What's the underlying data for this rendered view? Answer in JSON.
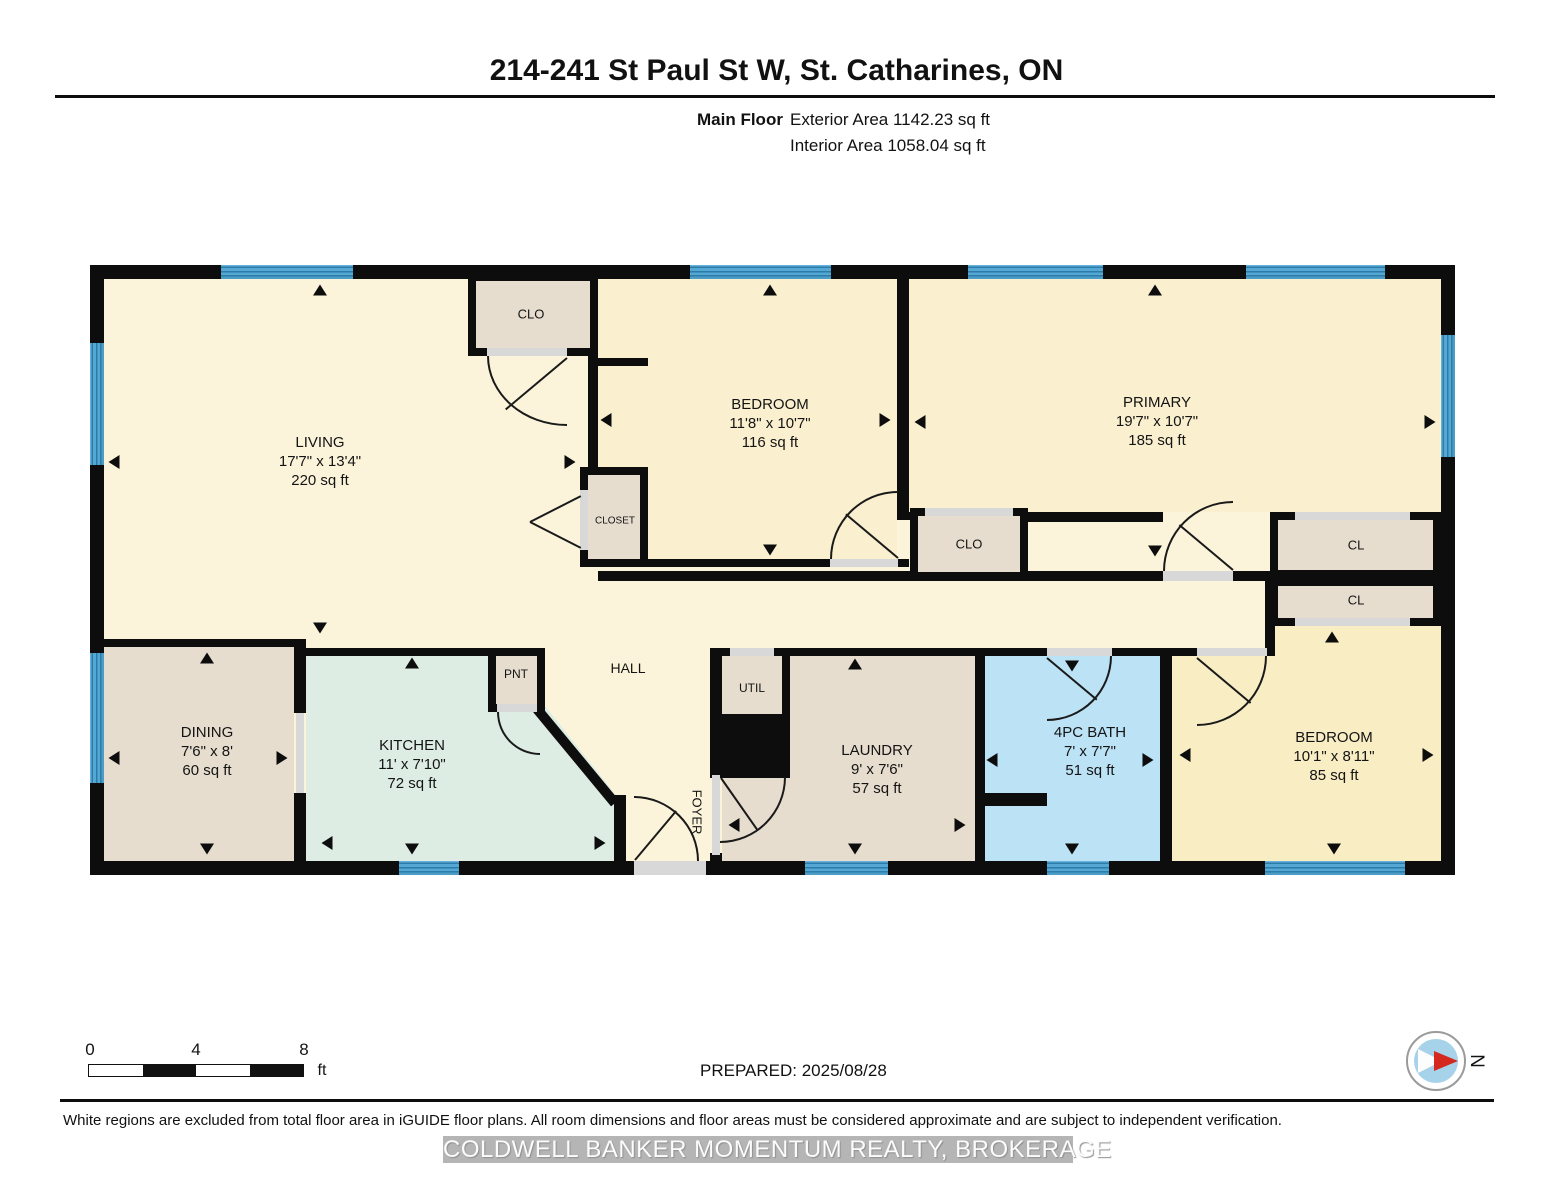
{
  "header": {
    "title": "214-241 St Paul St W, St. Catharines, ON",
    "floor_label": "Main Floor",
    "exterior_area": "Exterior Area 1142.23 sq ft",
    "interior_area": "Interior Area 1058.04 sq ft"
  },
  "rooms": {
    "living": {
      "name": "LIVING",
      "dims": "17'7\" x 13'4\"",
      "area": "220 sq ft"
    },
    "bedroom1": {
      "name": "BEDROOM",
      "dims": "11'8\" x 10'7\"",
      "area": "116 sq ft"
    },
    "primary": {
      "name": "PRIMARY",
      "dims": "19'7\" x 10'7\"",
      "area": "185 sq ft"
    },
    "dining": {
      "name": "DINING",
      "dims": "7'6\" x 8'",
      "area": "60 sq ft"
    },
    "kitchen": {
      "name": "KITCHEN",
      "dims": "11' x 7'10\"",
      "area": "72 sq ft"
    },
    "laundry": {
      "name": "LAUNDRY",
      "dims": "9' x 7'6\"",
      "area": "57 sq ft"
    },
    "bath": {
      "name": "4PC BATH",
      "dims": "7' x 7'7\"",
      "area": "51 sq ft"
    },
    "bedroom2": {
      "name": "BEDROOM",
      "dims": "10'1\" x 8'11\"",
      "area": "85 sq ft"
    }
  },
  "labels": {
    "hall": "HALL",
    "foyer": "FOYER",
    "closet": "CLOSET",
    "clo_top": "CLO",
    "clo_mid": "CLO",
    "cl_upper": "CL",
    "cl_lower": "CL",
    "pnt": "PNT",
    "util": "UTIL"
  },
  "scale_bar": {
    "tick0": "0",
    "tick4": "4",
    "tick8": "8",
    "unit": "ft"
  },
  "compass": {
    "label": "N"
  },
  "footer": {
    "prepared": "PREPARED: 2025/08/28",
    "disclaimer": "White regions are excluded from total floor area in iGUIDE floor plans. All room dimensions and floor areas must be considered approximate and are subject to independent verification.",
    "brand": "COLDWELL BANKER MOMENTUM REALTY, BROKERAGE"
  },
  "colors": {
    "wall": "#0d0d0d",
    "room_cream": "#FBF4DA",
    "bedroom_cream": "#FAF0CF",
    "bedroom2_gold": "#F9EDC4",
    "tan": "#E6DDCE",
    "kitchen_mint": "#DEEDE4",
    "bath_blue": "#BCE2F6",
    "window_blue": "#55A7D4",
    "door_gray": "#D8D8D8",
    "compass_red": "#D5281E"
  }
}
